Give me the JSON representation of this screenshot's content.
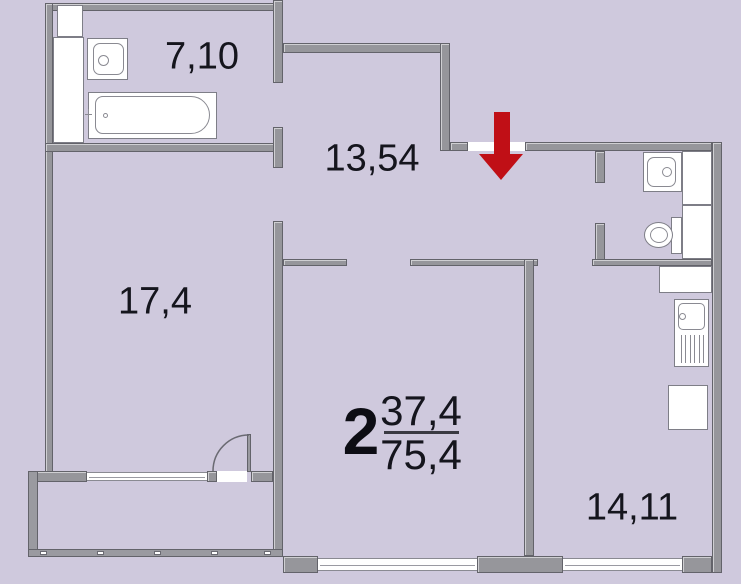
{
  "plan": {
    "type": "apartment-floor-plan",
    "summary": {
      "rooms_count": "2",
      "living_area": "37,4",
      "total_area": "75,4"
    },
    "rooms": [
      {
        "id": "bathroom",
        "area_label": "7,10"
      },
      {
        "id": "hallway-entrance",
        "area_label": "13,54"
      },
      {
        "id": "room-left",
        "area_label": "17,4"
      },
      {
        "id": "room-right-kitchen",
        "area_label": "14,11"
      }
    ],
    "fixtures": [
      "bathtub-icon",
      "bathroom-sink-icon",
      "wc-sink-icon",
      "toilet-icon",
      "kitchen-sink-icon",
      "entrance-arrow-icon",
      "balcony-door-arc-icon"
    ],
    "colors": {
      "background": "#cfc9dd",
      "wall": "#96969b",
      "wall_border": "#63636a",
      "fixture_fill": "#ffffff",
      "entrance_arrow_red": "#c00f16",
      "label_text": "#15151d"
    }
  }
}
